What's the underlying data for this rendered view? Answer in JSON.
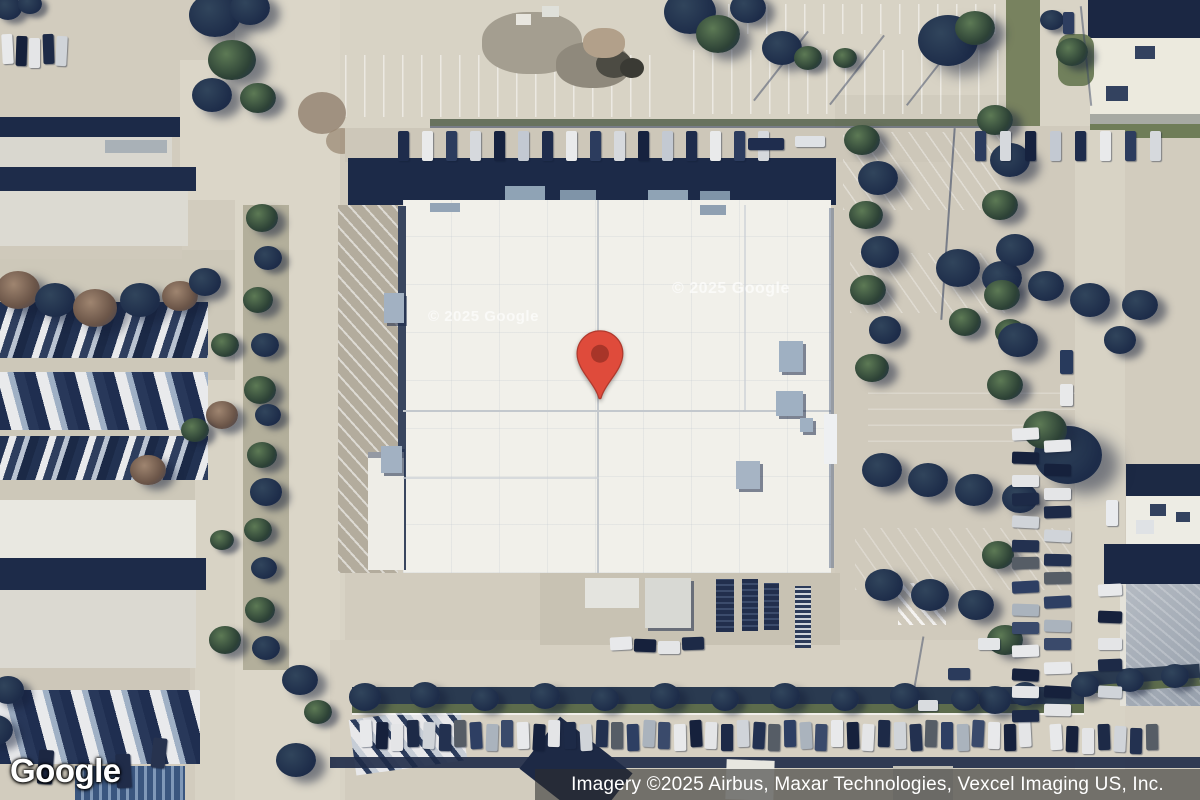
{
  "map": {
    "type": "satellite-imagery",
    "watermarks": [
      "© 2025 Google",
      "© 2025 Google"
    ],
    "marker": {
      "name": "red-location-pin",
      "color": "#DF4B3B",
      "stroke_color": "#B0392D",
      "inner_color": "#A83529"
    }
  },
  "footer": {
    "logo": "Google",
    "attribution": "Imagery ©2025 Airbus, Maxar Technologies, Vexcel Imaging US, Inc."
  },
  "colors": {
    "ground": "#d2ccbe",
    "road": "#dbd6c8",
    "main_roof": "#f1f0ea",
    "warehouse_roof": "#dcdad2",
    "shadow_navy": "#1c2a48",
    "tree_dark": "#1d2c49",
    "tree_green": "#2d4236",
    "attribution_bg": "rgba(45,45,45,0.58)"
  }
}
